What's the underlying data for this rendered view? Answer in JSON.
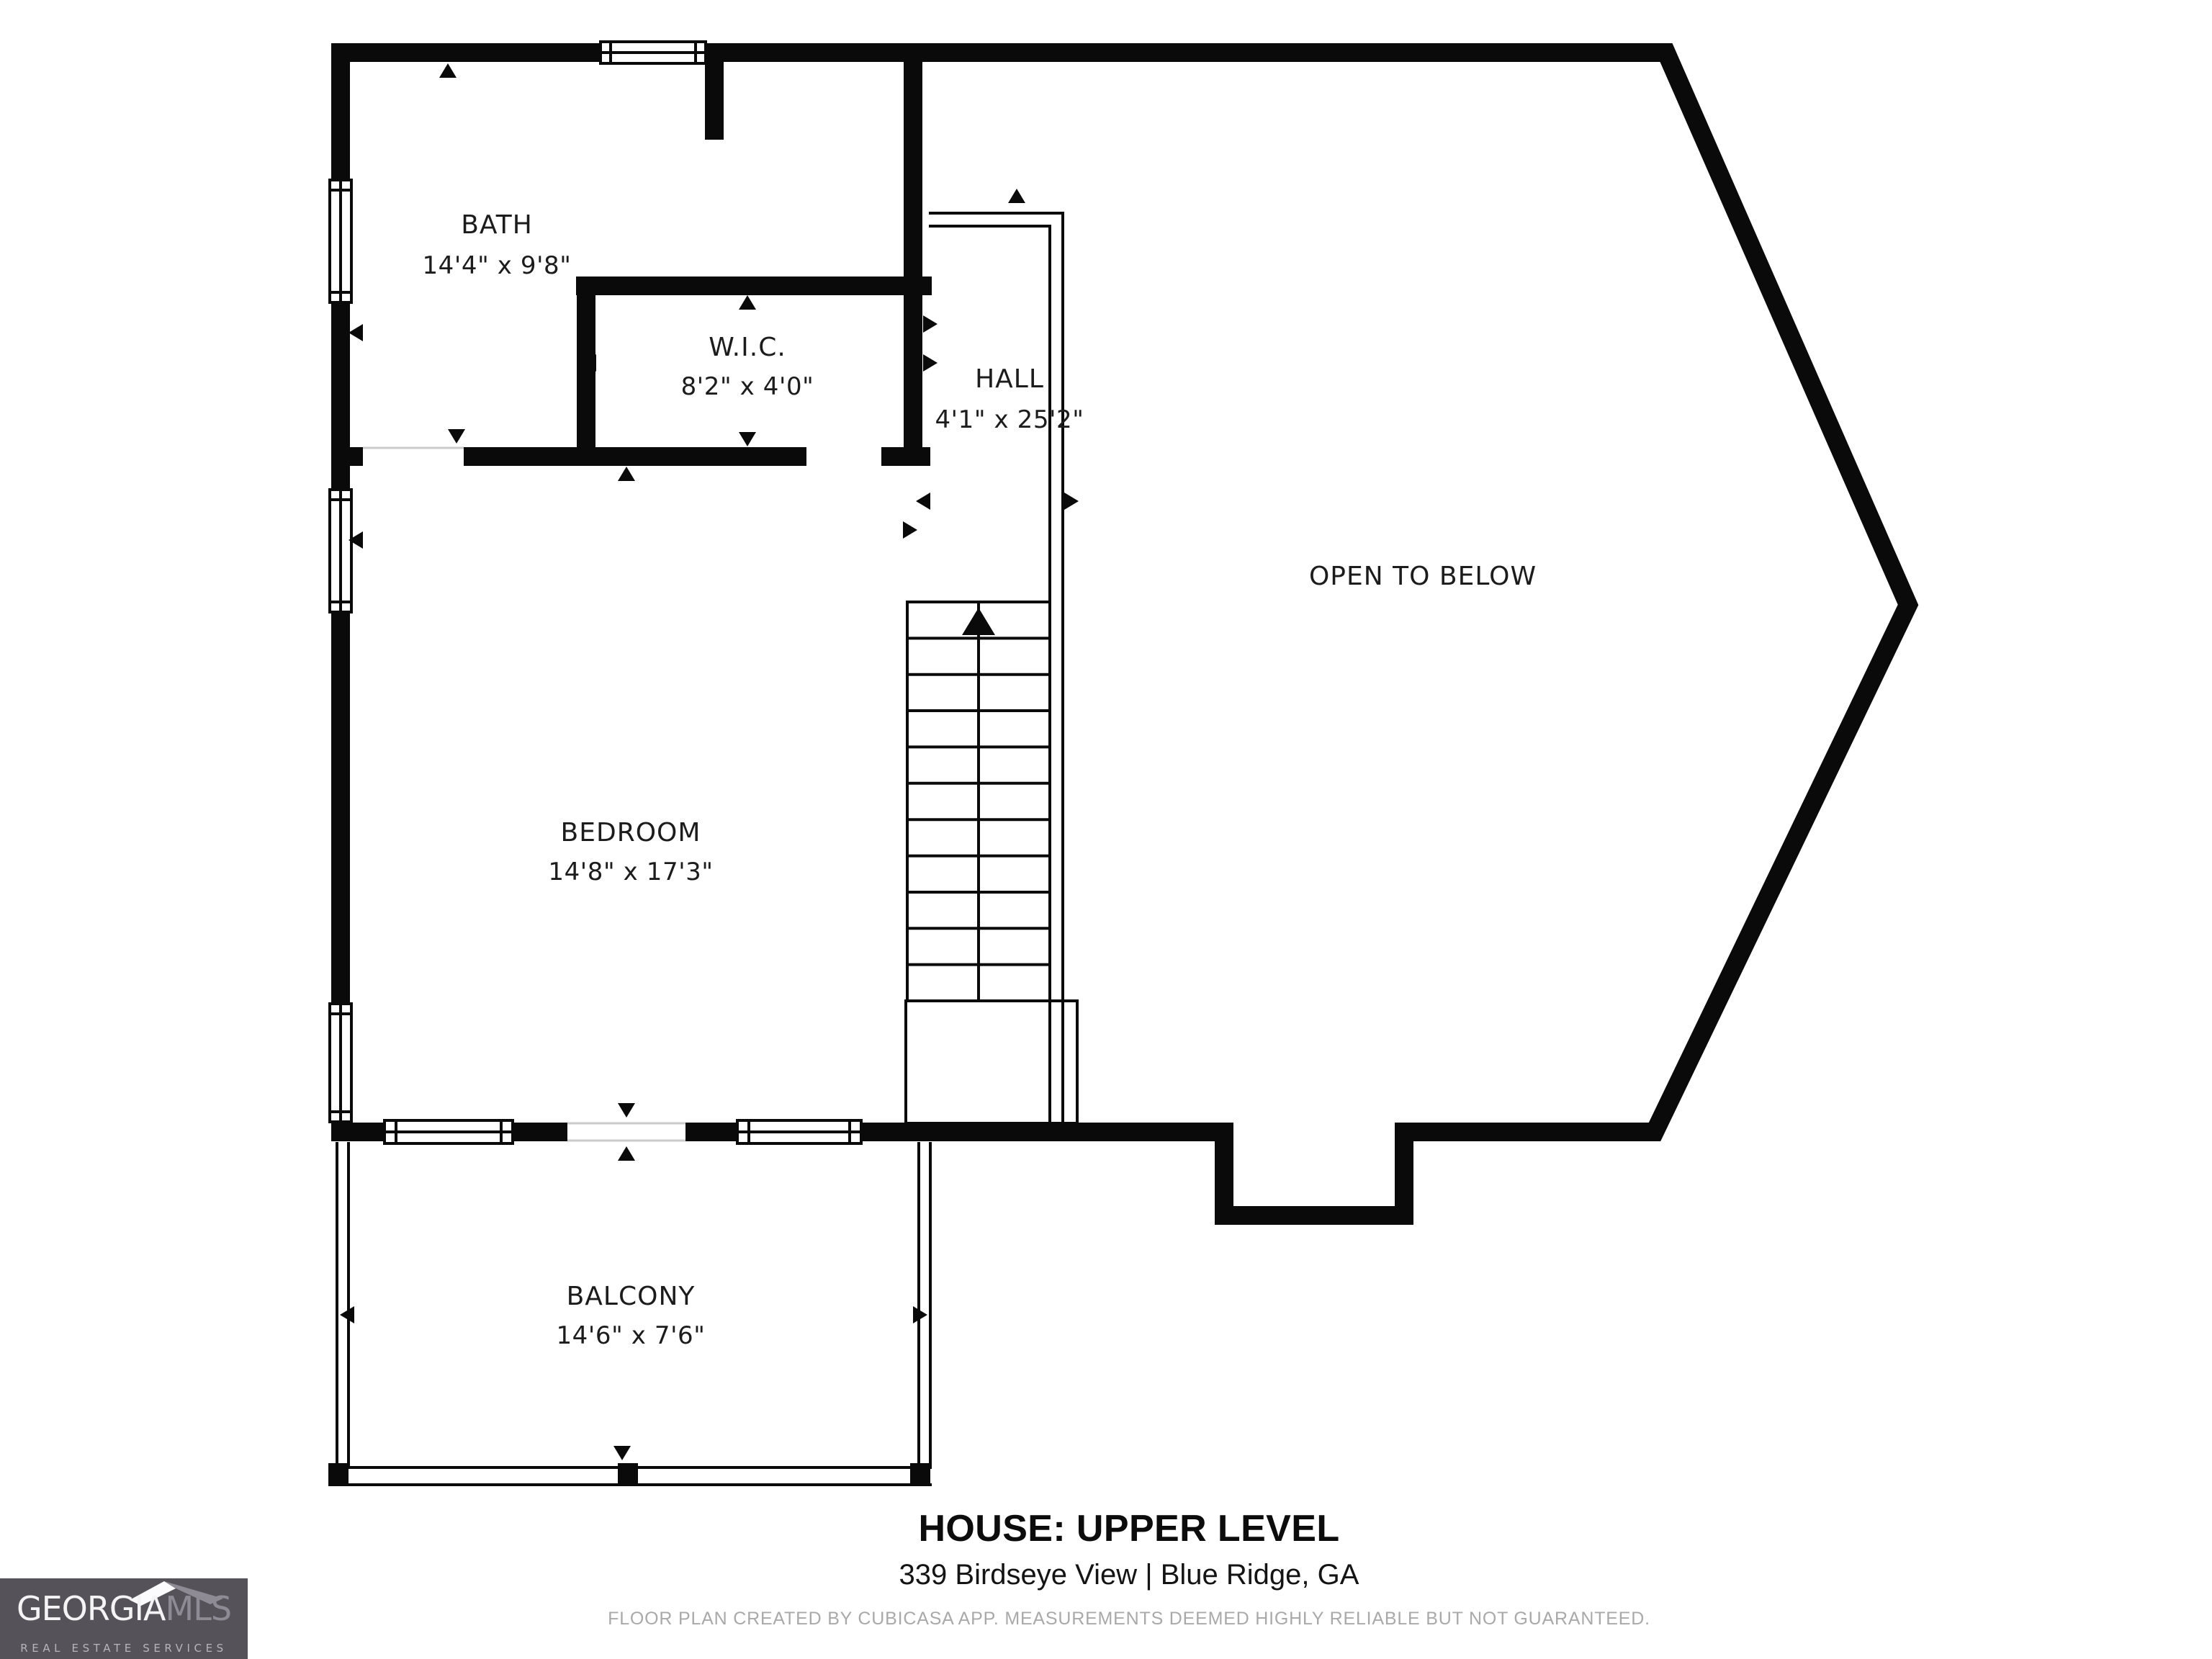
{
  "plan": {
    "rooms": [
      {
        "id": "bath",
        "name": "BATH",
        "dims": "14'4\" x 9'8\""
      },
      {
        "id": "wic",
        "name": "W.I.C.",
        "dims": "8'2\" x 4'0\""
      },
      {
        "id": "hall",
        "name": "HALL",
        "dims": "4'1\" x 25'2\""
      },
      {
        "id": "open",
        "name": "OPEN TO BELOW",
        "dims": ""
      },
      {
        "id": "bedroom",
        "name": "BEDROOM",
        "dims": "14'8\" x 17'3\""
      },
      {
        "id": "balcony",
        "name": "BALCONY",
        "dims": "14'6\" x 7'6\""
      }
    ]
  },
  "footer": {
    "title": "HOUSE: UPPER LEVEL",
    "address": "339 Birdseye View  |  Blue Ridge, GA",
    "disclaimer": "FLOOR PLAN CREATED BY CUBICASA APP. MEASUREMENTS DEEMED HIGHLY RELIABLE BUT NOT GUARANTEED."
  },
  "logo": {
    "brand_primary": "GEORGIA",
    "brand_secondary": "MLS",
    "tagline": "REAL ESTATE SERVICES"
  },
  "colors": {
    "wall": "#0a0a0a",
    "label_text": "#1c1c1c",
    "disclaimer_text": "#a9a9a9",
    "logo_background": "#55525a"
  }
}
